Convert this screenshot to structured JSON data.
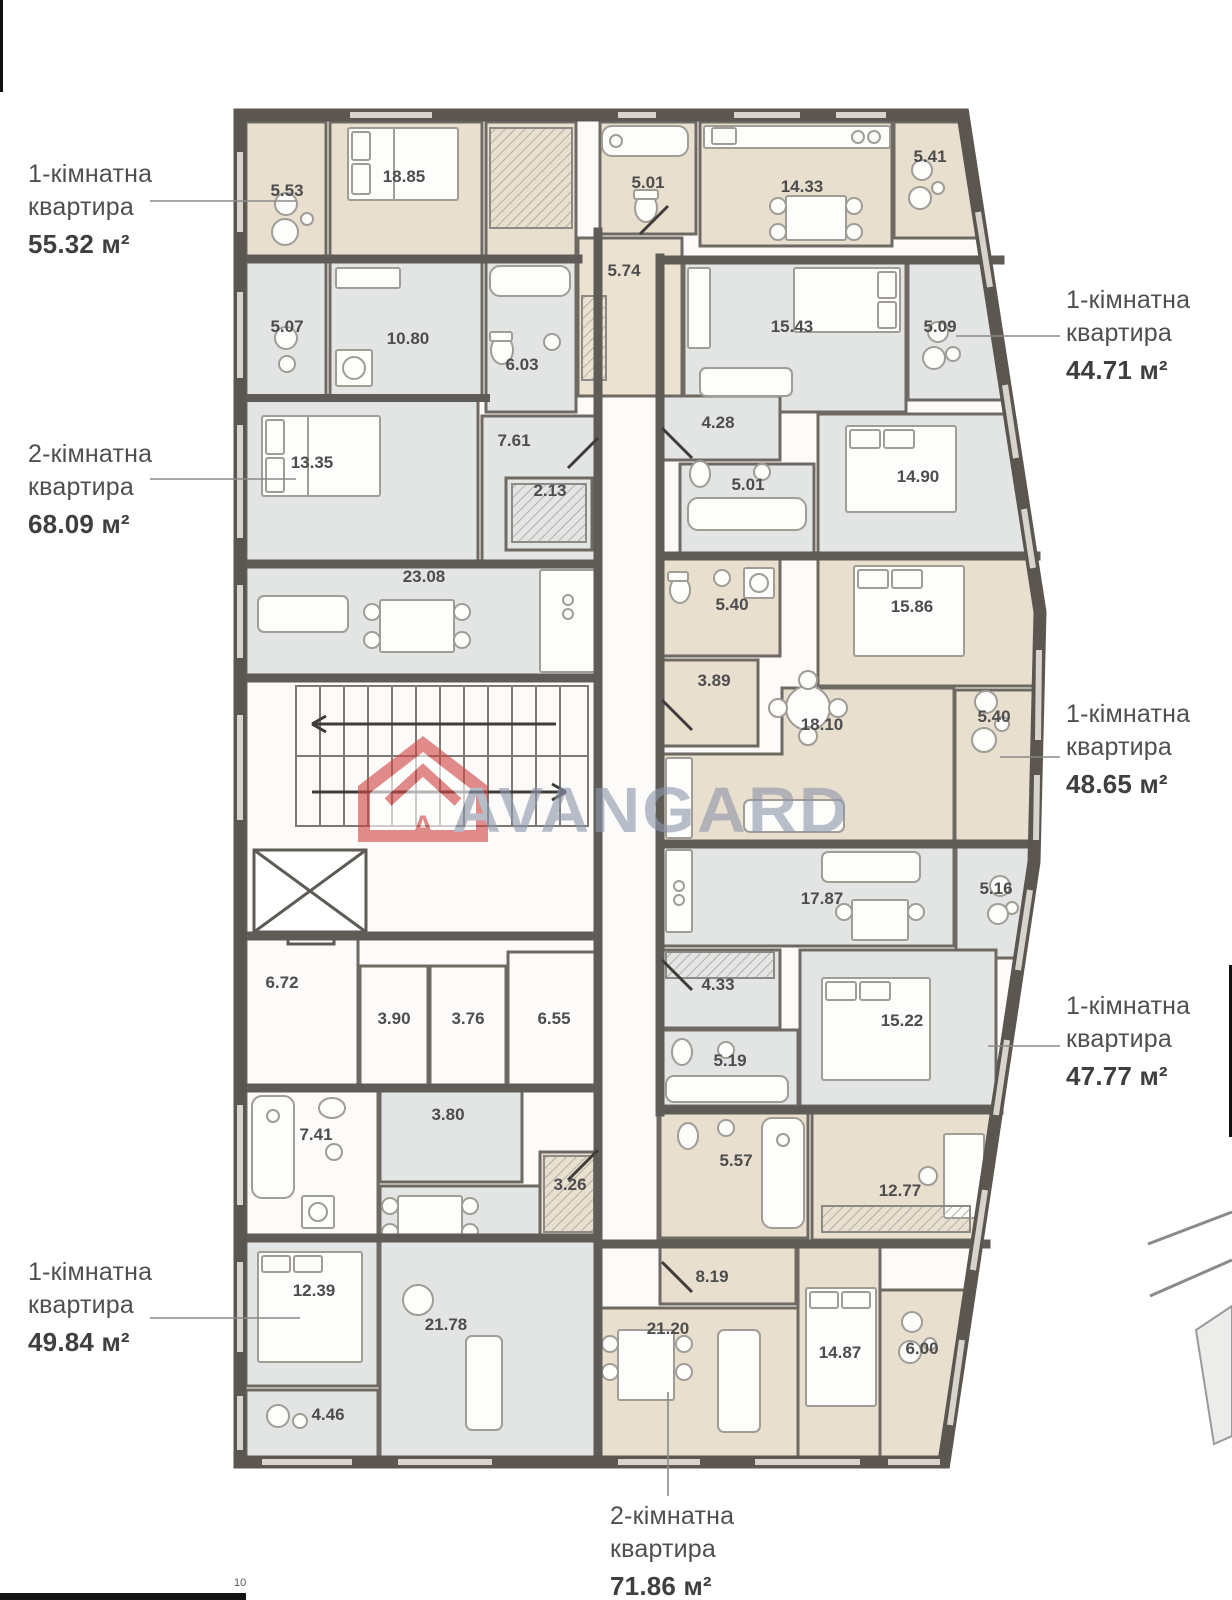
{
  "page": {
    "number": "10"
  },
  "watermark": {
    "brand": "AVANGARD",
    "logo_letter": "A"
  },
  "colors": {
    "beige_room": "#e8dfce",
    "gray_room": "#e3e5e4",
    "hall_room": "#ece2d2",
    "white_room": "#fcfbf9",
    "wall": "#5b5650",
    "inner_wall": "#6e6963",
    "accent_red": "#cf4746",
    "watermark_text": "#8e97ac",
    "label_text": "#4d4d4d"
  },
  "apartments": [
    {
      "id": "apt-55",
      "line1": "1-кімнатна",
      "line2": "квартира",
      "area": "55.32 м²"
    },
    {
      "id": "apt-44",
      "line1": "1-кімнатна",
      "line2": "квартира",
      "area": "44.71 м²"
    },
    {
      "id": "apt-68",
      "line1": "2-кімнатна",
      "line2": "квартира",
      "area": "68.09 м²"
    },
    {
      "id": "apt-48",
      "line1": "1-кімнатна",
      "line2": "квартира",
      "area": "48.65 м²"
    },
    {
      "id": "apt-47",
      "line1": "1-кімнатна",
      "line2": "квартира",
      "area": "47.77 м²"
    },
    {
      "id": "apt-49",
      "line1": "1-кімнатна",
      "line2": "квартира",
      "area": "49.84 м²"
    },
    {
      "id": "apt-71",
      "line1": "2-кімнатна",
      "line2": "квартира",
      "area": "71.86 м²"
    }
  ],
  "rooms": {
    "a1_balc": "5.53",
    "a1_bed": "18.85",
    "a1_bath": "5.01",
    "a1_kitch": "14.33",
    "a1_balc2": "5.41",
    "hall": "5.74",
    "a2_balc": "5.07",
    "a2_kitch": "10.80",
    "a2_bath": "6.03",
    "a2_bed": "13.35",
    "a2_hall": "7.61",
    "a2_ward": "2.13",
    "a2_liv": "23.08",
    "a3_liv": "15.43",
    "a3_balc": "5.09",
    "a3_hall": "4.28",
    "a3_bath": "5.01",
    "a3_bed": "14.90",
    "a4_bath": "5.40",
    "a4_bed": "15.86",
    "a4_hall": "3.89",
    "a4_liv": "18.10",
    "a4_balc": "5.40",
    "a5_liv": "17.87",
    "a5_balc": "5.16",
    "a5_hall": "4.33",
    "a5_bath": "5.19",
    "a5_bed": "15.22",
    "st1": "6.72",
    "st2": "3.90",
    "st3": "3.76",
    "st4": "6.55",
    "a6_bath": "7.41",
    "a6_hall": "3.80",
    "a6_bed": "12.39",
    "a6_liv": "21.78",
    "a6_balc": "4.46",
    "a7_ward": "3.26",
    "a7_bath": "5.57",
    "a7_cab": "12.77",
    "a7_hall": "8.19",
    "a7_liv": "21.20",
    "a7_bed": "14.87",
    "a7_balc": "6.00"
  }
}
